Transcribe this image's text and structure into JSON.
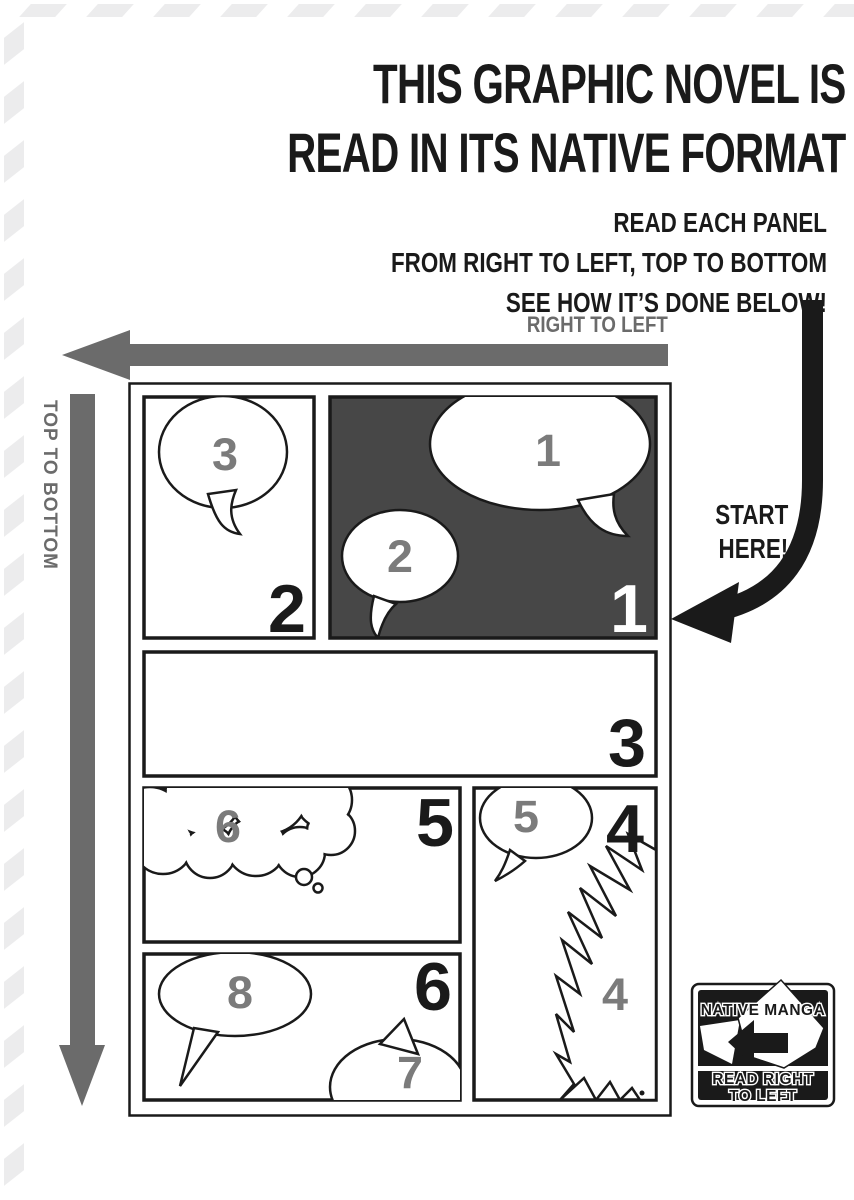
{
  "header": {
    "title_line1": "THIS GRAPHIC NOVEL IS",
    "title_line2": "READ IN ITS NATIVE FORMAT",
    "subtitle_line1": "READ EACH PANEL",
    "subtitle_line2": "FROM RIGHT TO LEFT, TOP TO BOTTOM",
    "subtitle_line3": "SEE HOW IT’S DONE BELOW!"
  },
  "direction_labels": {
    "horizontal": "RIGHT TO LEFT",
    "vertical": "TOP TO BOTTOM"
  },
  "start_note": {
    "line1": "START",
    "line2": "HERE!"
  },
  "comic": {
    "panel_numbers": {
      "p1": "1",
      "p2": "2",
      "p3": "3",
      "p4": "4",
      "p5": "5",
      "p6": "6"
    },
    "bubble_numbers": {
      "b1": "1",
      "b2": "2",
      "b3": "3",
      "b4": "4",
      "b5": "5",
      "b6": "6",
      "b7": "7",
      "b8": "8"
    }
  },
  "badge": {
    "title": "NATIVE MANGA",
    "line1": "READ RIGHT",
    "line2": "TO LEFT"
  },
  "colors": {
    "ink": "#1a1a1a",
    "arrow_gray": "#6b6b6b",
    "panel_dark_fill": "#474747",
    "bubble_number_gray": "#7b7b7b",
    "stripe_gray": "#ececed"
  }
}
